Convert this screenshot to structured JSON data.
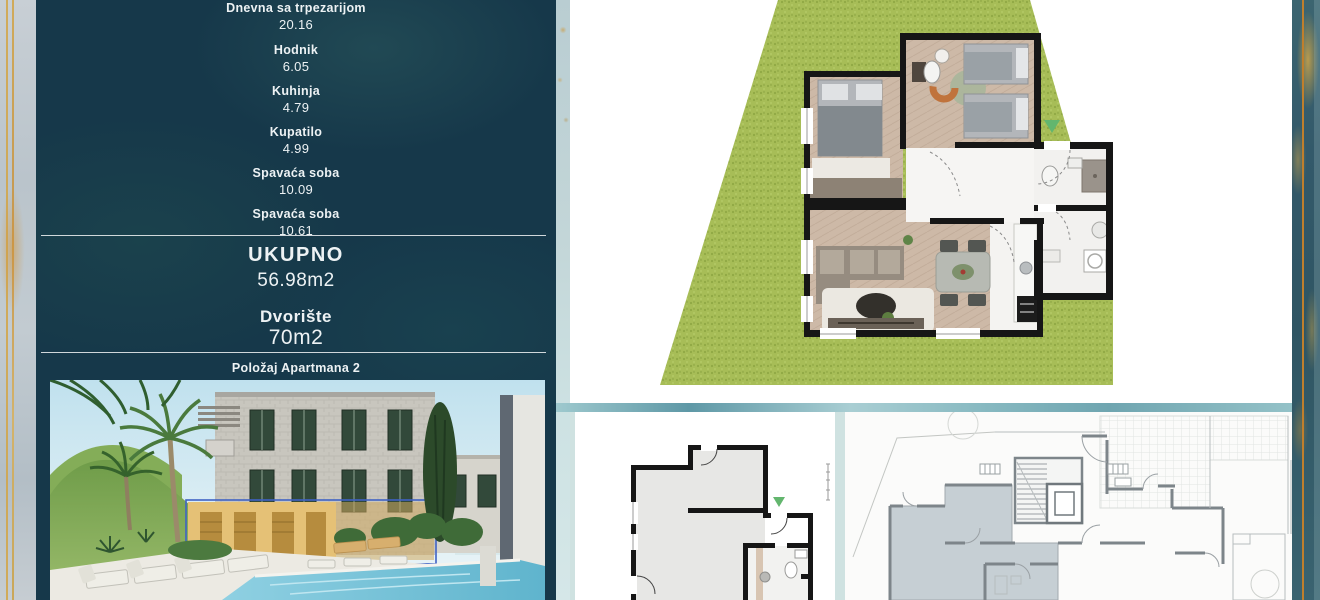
{
  "info_panel": {
    "rooms": [
      {
        "label": "Dnevna sa trpezarijom",
        "value": "20.16"
      },
      {
        "label": "Hodnik",
        "value": "6.05"
      },
      {
        "label": "Kuhinja",
        "value": "4.79"
      },
      {
        "label": "Kupatilo",
        "value": "4.99"
      },
      {
        "label": "Spavaća soba",
        "value": "10.09"
      },
      {
        "label": "Spavaća soba",
        "value": "10.61"
      }
    ],
    "total": {
      "label": "UKUPNO",
      "value": "56.98m2"
    },
    "yard": {
      "label": "Dvorište",
      "value": "70m2"
    },
    "position_caption": "Položaj Apartmana 2"
  },
  "colors": {
    "panel_background": "#16384a",
    "text": "#edf2f4",
    "grass": "#a7bd57",
    "wood_floor": "#cdb9a7",
    "wall_black": "#161616",
    "teal_band": "#6fa5b0",
    "border_gold": "#d2a445",
    "border_orange": "#c07f2c",
    "apartment_shade": "#b9c5cb",
    "highlight_yellow": "#e5c176",
    "highlight_outline": "#3f62c4",
    "entrance_arrow_green": "#63b66e"
  },
  "icons": {
    "entrance_arrow": "green triangle pointing down marking apartment entrance"
  }
}
